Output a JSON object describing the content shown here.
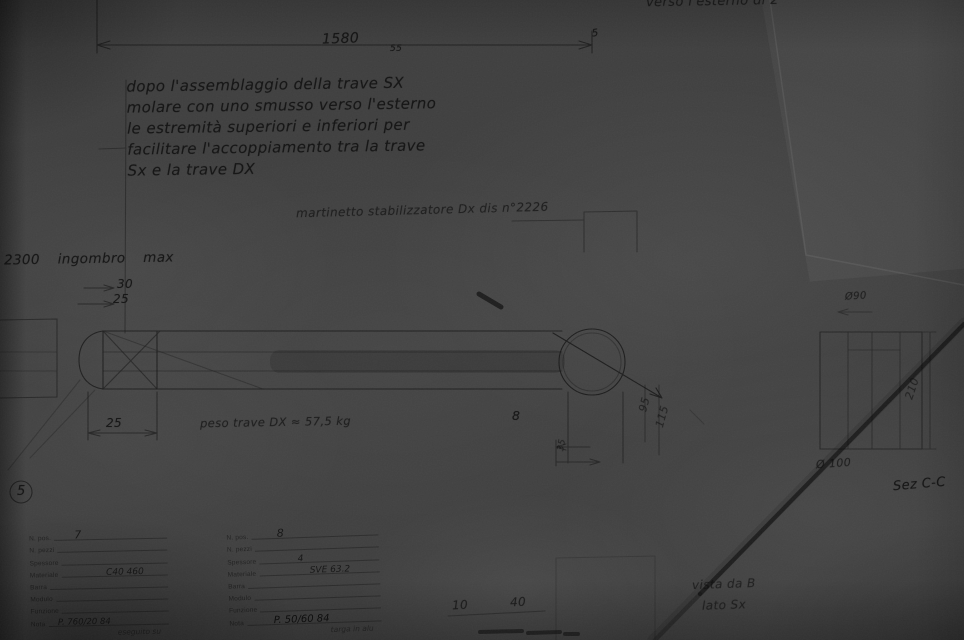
{
  "photo": {
    "paper_color": "#3f3f3f",
    "pencil_color": "#161616"
  },
  "notes": {
    "assembly": [
      "dopo l'assemblaggio della trave SX",
      "molare con uno smusso verso l'esterno",
      "le estremità superiori e inferiori per",
      "facilitare l'accoppiamento tra la trave",
      "Sx e la trave DX"
    ],
    "top_right": "verso l'esterno di 2°",
    "martinetto": "martinetto stabilizzatore Dx dis n°2226",
    "ingombro": "2300  ingombro  max",
    "peso": "peso trave DX ≈ 57,5 kg",
    "vista": "vista da B",
    "lato": "lato Sx",
    "sezione": "Sez C-C"
  },
  "dimensions": {
    "d1580": "1580",
    "d1580_tol": "55",
    "d5": "5",
    "d30": "30",
    "d25a": "25",
    "d25b": "25",
    "d8": "8",
    "d95": "95",
    "d115": "115",
    "d35": "35",
    "d210": "210",
    "dia90": "Ø90",
    "dia100": "Ø 100",
    "d10": "10",
    "d40": "40",
    "balloon": "5"
  },
  "title_blocks": {
    "block1": {
      "rows": [
        {
          "label": "N. pos.",
          "value": "7"
        },
        {
          "label": "N. pezzi",
          "value": ""
        },
        {
          "label": "Spessore",
          "value": ""
        },
        {
          "label": "Materiale",
          "value": "C40 460"
        },
        {
          "label": "Barra",
          "value": ""
        },
        {
          "label": "Modulo",
          "value": ""
        },
        {
          "label": "Funzione",
          "value": ""
        },
        {
          "label": "Nota",
          "value": "P. 760/20 84"
        }
      ],
      "footnote": "eseguito su"
    },
    "block2": {
      "rows": [
        {
          "label": "N. pos.",
          "value": "8"
        },
        {
          "label": "N. pezzi",
          "value": ""
        },
        {
          "label": "Spessore",
          "value": "4"
        },
        {
          "label": "Materiale",
          "value": "SVE 63.2"
        },
        {
          "label": "Barra",
          "value": ""
        },
        {
          "label": "Modulo",
          "value": ""
        },
        {
          "label": "Funzione",
          "value": ""
        },
        {
          "label": "Nota",
          "value": "P. 50/60 84"
        }
      ],
      "footnote": "targa in alu"
    }
  }
}
